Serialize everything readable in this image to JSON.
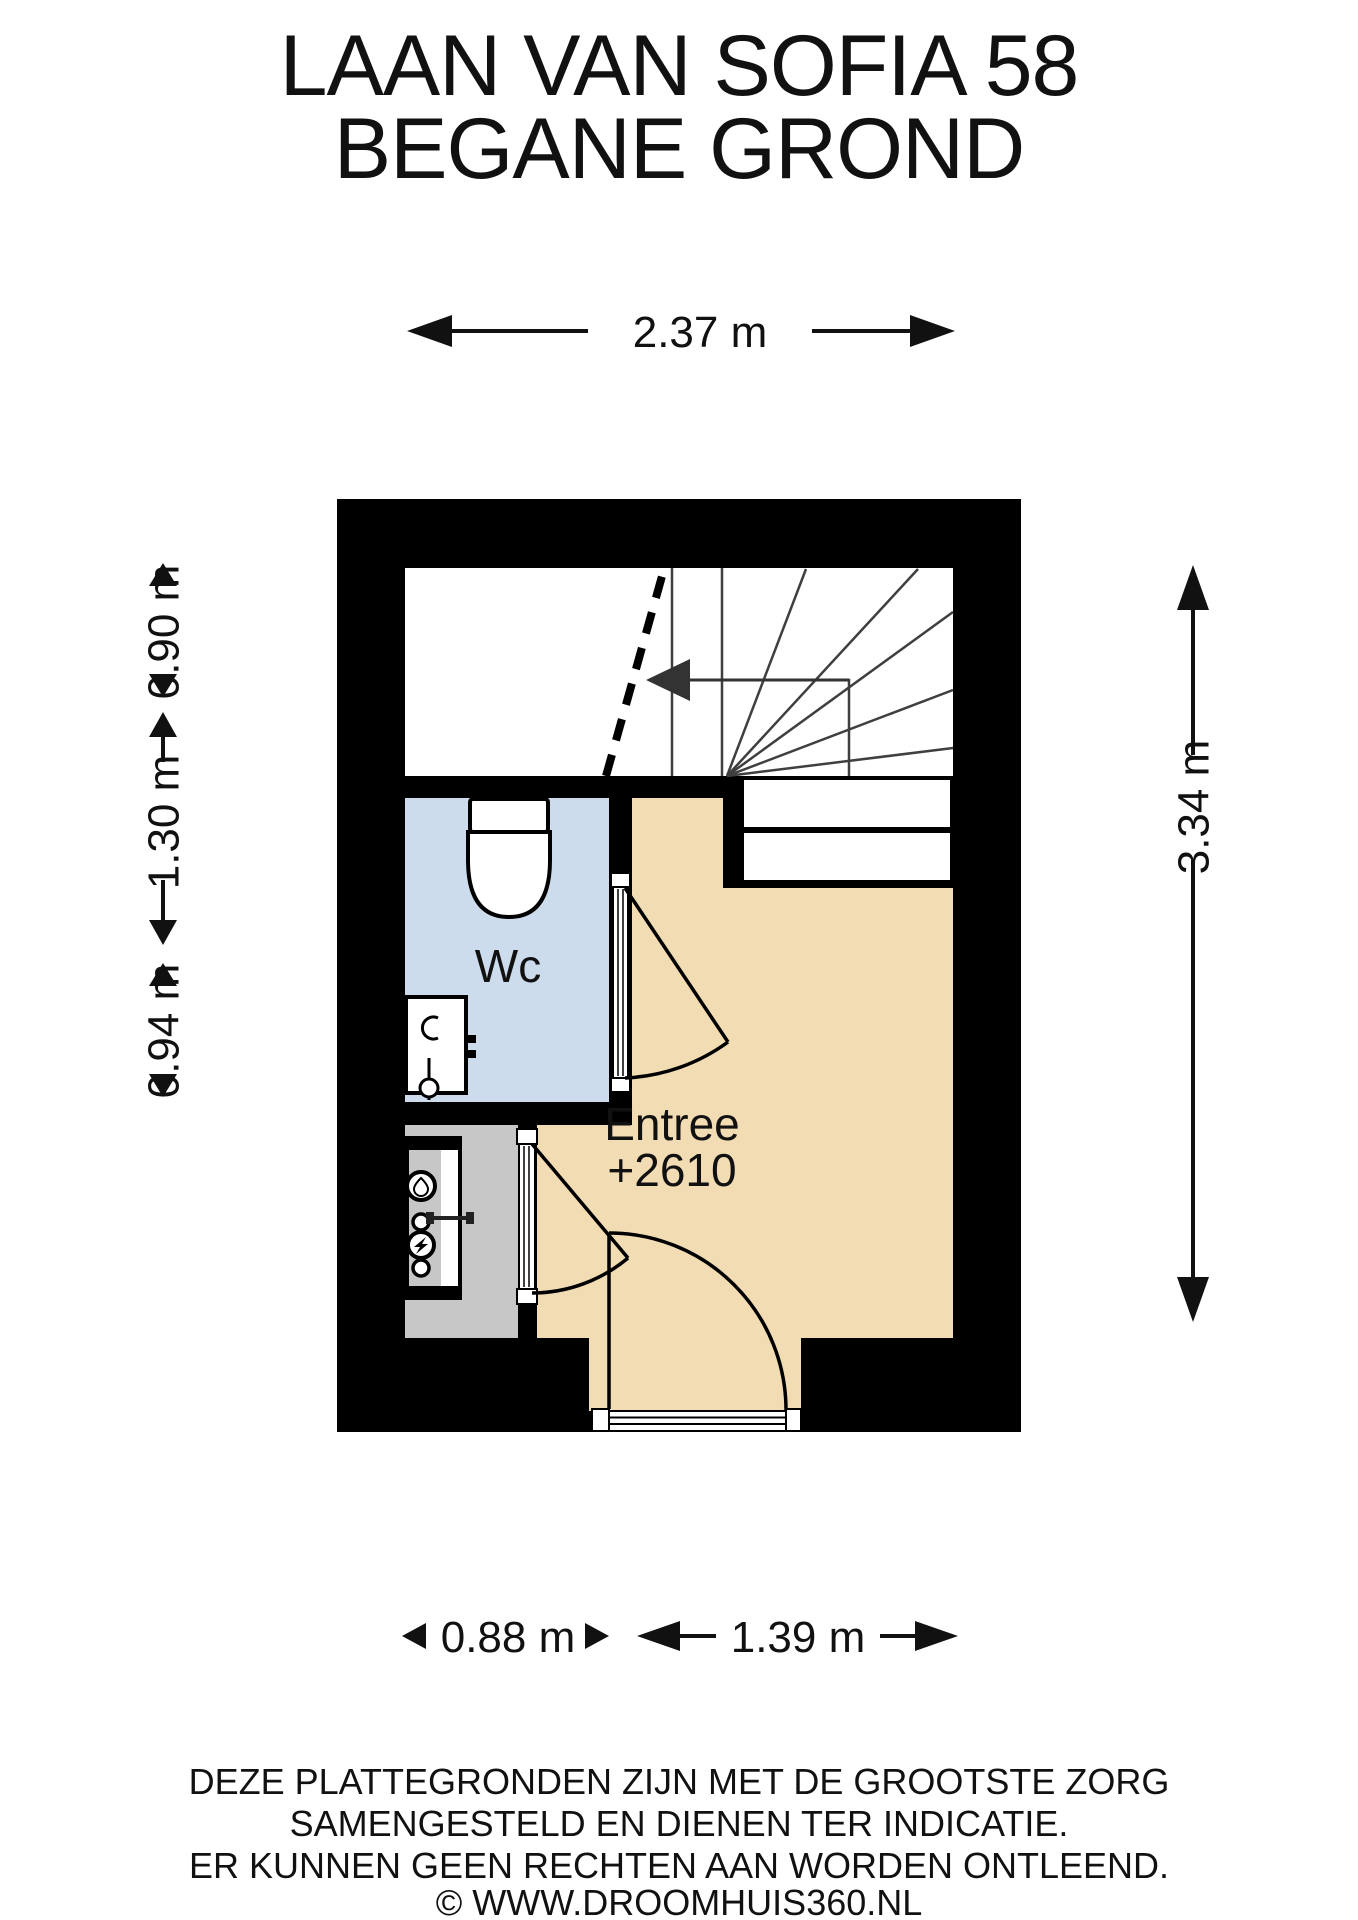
{
  "title": {
    "line1": "LAAN VAN SOFIA 58",
    "line2": "BEGANE GROND"
  },
  "dimensions": {
    "top_width": "2.37 m",
    "right_height": "3.34 m",
    "left_top": "0.90 m",
    "left_middle": "1.30 m",
    "left_bottom": "0.94 m",
    "bottom_left": "0.88 m",
    "bottom_right": "1.39 m"
  },
  "rooms": {
    "wc": {
      "label": "Wc"
    },
    "entree": {
      "label": "Entree",
      "elevation": "+2610"
    }
  },
  "colors": {
    "wall": "#000000",
    "stairs_floor": "#ffffff",
    "wc_floor": "#ccdcec",
    "entree_floor": "#f2dcb4",
    "meter_floor": "#c7c7c7",
    "line": "#111111"
  },
  "disclaimer": {
    "line1": "DEZE PLATTEGRONDEN ZIJN MET DE GROOTSTE ZORG",
    "line2": "SAMENGESTELD EN DIENEN TER INDICATIE.",
    "line3": "ER KUNNEN GEEN RECHTEN AAN WORDEN ONTLEEND.",
    "line4": "© WWW.DROOMHUIS360.NL"
  }
}
